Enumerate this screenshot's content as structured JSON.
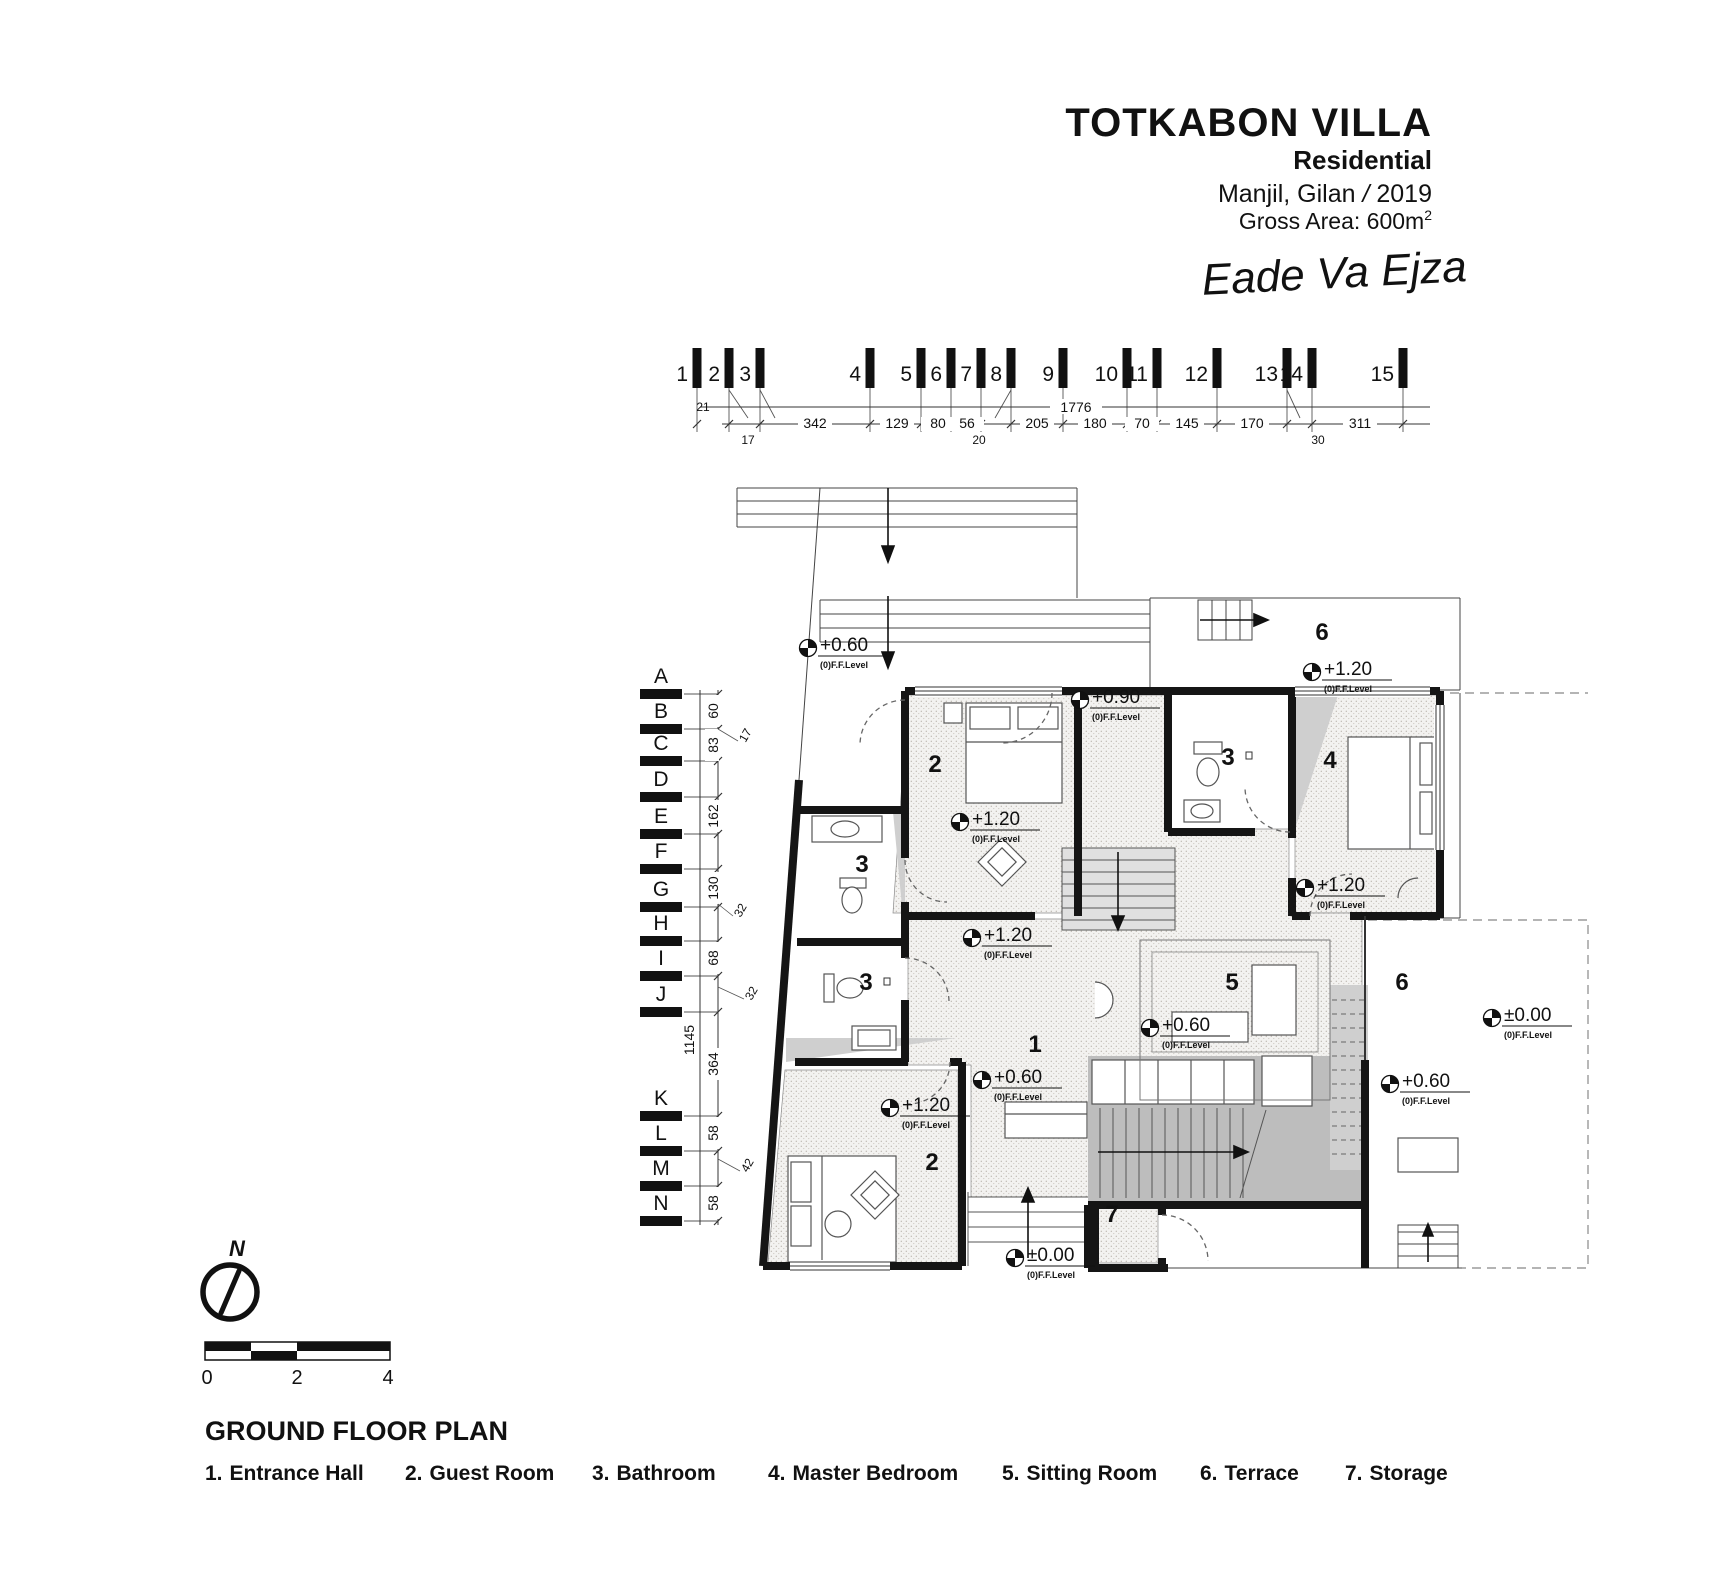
{
  "title_block": {
    "title": "TOTKABON VILLA",
    "subtitle": "Residential",
    "location": "Manjil, Gilan",
    "separator": "/",
    "year": "2019",
    "area_label": "Gross Area: 600m",
    "area_sup": "2",
    "signature": "Eade Va Ejza"
  },
  "top_grid": {
    "axis_labels": [
      "1",
      "2",
      "3",
      "4",
      "5",
      "6",
      "7",
      "8",
      "9",
      "10",
      "11",
      "12",
      "13",
      "14",
      "15"
    ],
    "overall_dim": "1776",
    "segment_dims": [
      "342",
      "129",
      "80",
      "56",
      "205",
      "180",
      "70",
      "145",
      "170",
      "311"
    ],
    "small_dims": [
      "21",
      "17",
      "20",
      "30"
    ]
  },
  "left_grid": {
    "axis_labels": [
      "A",
      "B",
      "C",
      "D",
      "E",
      "F",
      "G",
      "H",
      "I",
      "J",
      "K",
      "L",
      "M",
      "N"
    ],
    "overall_dim": "1145",
    "segment_dims": [
      "60",
      "83",
      "162",
      "130",
      "68",
      "364",
      "58",
      "58"
    ],
    "small_dims": [
      "17",
      "32",
      "32",
      "42"
    ]
  },
  "plan": {
    "room_numbers": [
      "2",
      "3",
      "4",
      "3",
      "3",
      "1",
      "5",
      "6",
      "6",
      "2",
      "7"
    ],
    "level_values": [
      "+0.60",
      "+1.20",
      "+0.90",
      "+1.20",
      "+1.20",
      "+1.20",
      "+0.60",
      "±0.00",
      "+0.60",
      "+0.60",
      "+1.20",
      "±0.00"
    ],
    "level_sub": "(0)F.F.Level"
  },
  "footer": {
    "north_label": "N",
    "scale_ticks": [
      "0",
      "2",
      "4"
    ],
    "plan_title": "GROUND FLOOR PLAN",
    "legend": [
      {
        "num": "1.",
        "label": "Entrance Hall"
      },
      {
        "num": "2.",
        "label": "Guest Room"
      },
      {
        "num": "3.",
        "label": "Bathroom"
      },
      {
        "num": "4.",
        "label": "Master Bedroom"
      },
      {
        "num": "5.",
        "label": "Sitting Room"
      },
      {
        "num": "6.",
        "label": "Terrace"
      },
      {
        "num": "7.",
        "label": "Storage"
      }
    ]
  }
}
